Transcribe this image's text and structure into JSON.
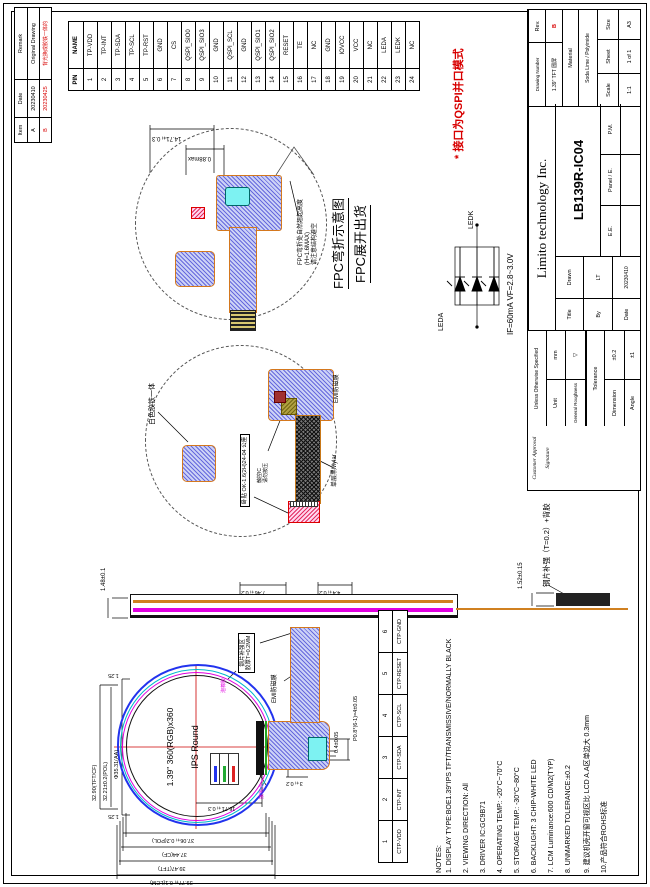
{
  "colors": {
    "accent_red": "#d80000",
    "fpc_blue": "#3c3ccd",
    "fpc_outline_orange": "#d4781e",
    "pad_cyan": "#7df2f2",
    "pol_magenta": "#e000e0",
    "stiffener_tan": "#d08020"
  },
  "revision_table": {
    "headers": [
      "Item",
      "Date",
      "Remark"
    ],
    "rows": [
      {
        "item": "A",
        "date": "20230410",
        "remark": "Original Drawing"
      },
      {
        "item": "B",
        "date": "20230425",
        "remark": "背光换成胶铁一体的"
      }
    ]
  },
  "pin_table": {
    "headers": [
      "PIN",
      "NAME"
    ],
    "rows": [
      {
        "pin": "1",
        "name": "TP-VDD"
      },
      {
        "pin": "2",
        "name": "TP-INT"
      },
      {
        "pin": "3",
        "name": "TP-SDA"
      },
      {
        "pin": "4",
        "name": "TP-SCL"
      },
      {
        "pin": "5",
        "name": "TP-RST"
      },
      {
        "pin": "6",
        "name": "GND"
      },
      {
        "pin": "7",
        "name": "CS"
      },
      {
        "pin": "8",
        "name": "QSPI_SIO0"
      },
      {
        "pin": "9",
        "name": "QSPI_SIO3"
      },
      {
        "pin": "10",
        "name": "GND"
      },
      {
        "pin": "11",
        "name": "QSPI_SCL"
      },
      {
        "pin": "12",
        "name": "GND"
      },
      {
        "pin": "13",
        "name": "QSPI_SIO1"
      },
      {
        "pin": "14",
        "name": "QSPI_SIO2"
      },
      {
        "pin": "15",
        "name": "RESET"
      },
      {
        "pin": "16",
        "name": "TE"
      },
      {
        "pin": "17",
        "name": "NC"
      },
      {
        "pin": "18",
        "name": "GND"
      },
      {
        "pin": "19",
        "name": "IOVCC"
      },
      {
        "pin": "20",
        "name": "VCC"
      },
      {
        "pin": "21",
        "name": "NC"
      },
      {
        "pin": "22",
        "name": "LEDA"
      },
      {
        "pin": "23",
        "name": "LEDK"
      },
      {
        "pin": "24",
        "name": "NC"
      }
    ]
  },
  "ctp_table": {
    "pins": [
      "1",
      "2",
      "3",
      "4",
      "5",
      "6"
    ],
    "names": [
      "CTP-VDD",
      "CTP-INT",
      "CTP-SDA",
      "CTP-SCL",
      "CTP-RESET",
      "CTP-GND"
    ]
  },
  "notes": {
    "header": "NOTES:",
    "items": [
      "1. DISPLAY TYPE:BOE1.39\"IPS TFT/TRANSMISSIVE/NORMALLY BLACK",
      "2. VIEWING DIRECTION: All",
      "3. DRIVER IC:GC9B71",
      "4. OPERATING TEMP.:  -20°C~70°C",
      "5. STORAGE TEMP.:  -30°C~80°C",
      "6. BACKLIGHT: 3 CHIP-WHITE LED",
      "7. LCM Luminance:600 CD/M2(TYP)",
      "8. UNMARKED TOLERANCE:±0.2",
      "9. 建议机壳开窗可视区比 LCD A.A区单边大 0.3mm",
      "10.产品符合ROHS标准"
    ]
  },
  "interface_note": "* 接口为QSPI并口模式",
  "captions": {
    "fpc_bend": "FPC弯折示意图",
    "fpc_ship": "FPC展开出货"
  },
  "led": {
    "anode": "LEDA",
    "cathode": "LEDK",
    "spec": "IF=60mA  VF=2.8~3.0V"
  },
  "drawing1": {
    "dim_width": "14.71±0.3",
    "dim_height": "0.88max",
    "note_l1": "FPC弯折处自然翘起高度",
    "note_l2": "(H≈1.6MAX)",
    "note_l3": "请注意结构避空"
  },
  "drawing2": {
    "label_backlight": "白色胶铁一体",
    "label_emi": "EMI防磁膜",
    "label_mylar": "单层黑Mylar",
    "label_connector": "卧贴 OK-1.6(2H)24-04 公座",
    "label_tp_l1": "触控IC",
    "label_tp_l2": "请勿按压"
  },
  "side_view": {
    "dim_top": "1.48±0.1",
    "dim_bottom": "1.52±0.15",
    "label_stiffener": "钢片补强（T=0.2）+背胶",
    "dim_seg1": "7.46±0.2",
    "dim_seg2": "4.4±0.2"
  },
  "front_view": {
    "line1": "1.39\" 360(RGB)x360",
    "line2": "IPS Round",
    "dims_left": [
      "37.06±0.2(POL)",
      "37.44(CF)",
      "39.47(TFT)",
      "39.77±0.1(LCM)"
    ],
    "dims_top": [
      "32.90(TFT/CF)",
      "32.21±0.2(POL)",
      "Φ35.31(AA)"
    ],
    "dim_offset_right": "1.25",
    "dim_offset_left": "1.25",
    "dim_fpc": "16.71±0.3",
    "dim_conn_offset": "3±0.2",
    "dim_pad": "0.4±0.05",
    "dim_pitch": "P0.8*(6-1)=4±0.05",
    "label_emi": "EMI防磁膜",
    "label_stiffener_l1": "钢片补强区",
    "label_stiffener_l2": "胶厚T=0.2MM",
    "label_foam": "泡棉胶",
    "label_ground": "接地点"
  },
  "title_block": {
    "company": "Limito technology Inc.",
    "model": "LB139R-IC04",
    "customer_l1": "Customer Approval",
    "customer_l2": "Signature",
    "unless": "Unless Otherwise Specified",
    "unit_label": "Unit",
    "unit_value": "mm",
    "roughness_label": "General Roughness",
    "roughness_symbol": "▽",
    "tolerance_label": "Tolerance",
    "dimension_label": "Dimension",
    "dimension_value": "±0.2",
    "angle_label": "Angle",
    "angle_value": "±1",
    "title_label": "Title",
    "by_label": "By",
    "date_label": "Date",
    "drawn_label": "Drawn",
    "drawn_value": "LT",
    "drawn_date": "20230410",
    "ee_label": "E.E.",
    "panel_label": "Panel / E.",
    "pm_label": "P.M.",
    "drawing_number_label": "Drawing Number",
    "drawing_number": "1.39\" TFT 圆屏",
    "rev_label": "Rev.",
    "rev_value": "B",
    "material_label": "Material",
    "material_value": "Soda Lime / Polyimide",
    "scale_label": "Scale",
    "scale_value": "1:1",
    "sheet_label": "Sheet",
    "sheet_value": "1 of 1",
    "size_label": "Size",
    "size_value": "A3"
  }
}
